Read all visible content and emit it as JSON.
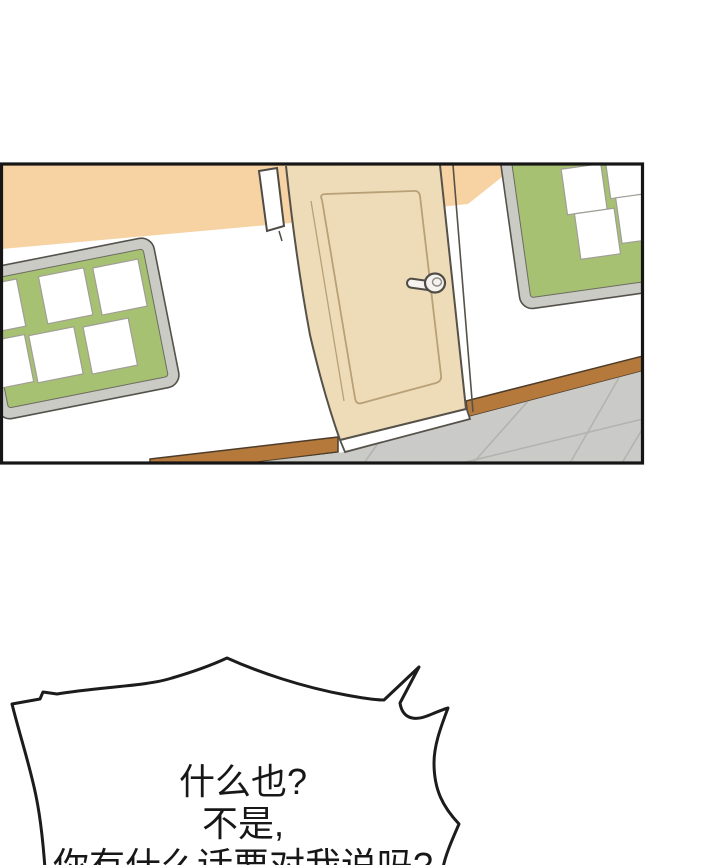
{
  "page": {
    "width": 720,
    "height": 865,
    "background": "#ffffff"
  },
  "panel": {
    "scene": "school-hallway",
    "border_color": "#161616",
    "wall_band_color": "#f7d2a3",
    "wall_color": "#ffffff",
    "door": {
      "color": "#eedcb8",
      "outline_color": "#56524a",
      "inner_line_color": "#b8a077",
      "threshold_color": "#ffffff",
      "handle_type": "lever",
      "handle_color": "#f4f3f0"
    },
    "door_sign_color": "#ffffff",
    "bulletin_boards": {
      "frame_color": "#cbcbc6",
      "surface_color": "#a7c172",
      "paper_color": "#ffffff",
      "left_board_papers": 6,
      "right_board_papers": 4
    },
    "baseboard_color": "#b5793c",
    "floor": {
      "tile_color": "#cdcdca",
      "grout_color": "#b3b3b0"
    }
  },
  "speech_bubble": {
    "fill": "#ffffff",
    "stroke": "#1c1c1c",
    "lines": {
      "0": "什么也?",
      "1": "不是,",
      "2": "你有什么话要对我说吗?"
    }
  }
}
